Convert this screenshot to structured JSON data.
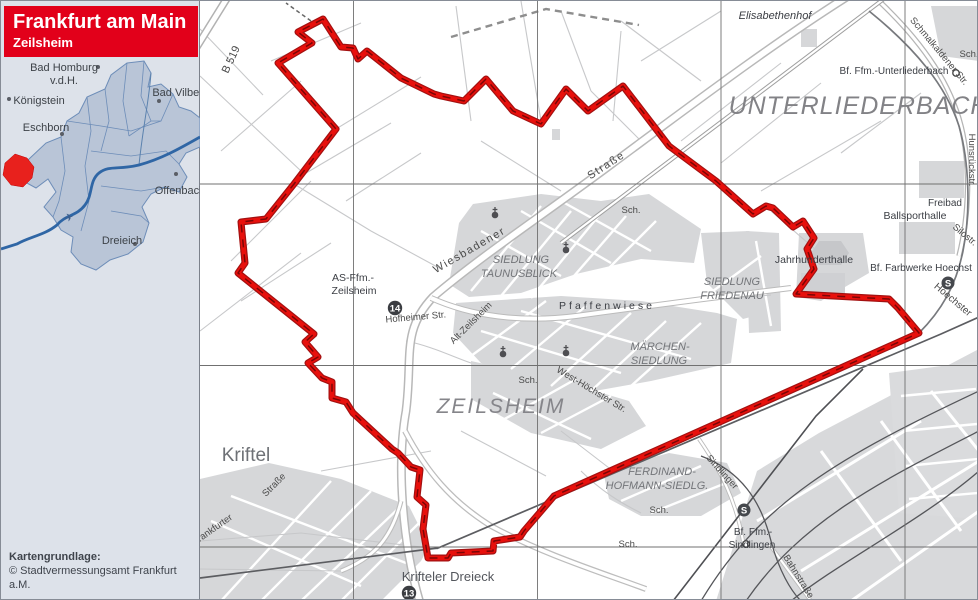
{
  "header": {
    "title": "Frankfurt am Main",
    "subtitle": "Zeilsheim"
  },
  "inset": {
    "bad_homburg_1": "Bad Homburg",
    "bad_homburg_2": "v.d.H.",
    "koenigstein": "Königstein",
    "bad_vilbel": "Bad Vilbel",
    "eschborn": "Eschborn",
    "offenbach": "Offenbach",
    "dreieich": "Dreieich",
    "airplane_icon": "✈"
  },
  "attribution": {
    "line1": "Kartengrundlage:",
    "line2": "© Stadtvermessungsamt Frankfurt a.M."
  },
  "map": {
    "b519": "B 519",
    "elisabethenhof": "Elisabethenhof",
    "schmalkaldener": "Schmalkaldener Str.",
    "bf_unterliederbach": "Bf. Ffm.-Unterliederbach",
    "unterliederbach": "UNTERLIEDERBACH",
    "sch": "Sch.",
    "hunsrueckstr": "Hunsrückstr.",
    "freibad": "Freibad",
    "ballsporthalle": "Ballsporthalle",
    "silostr": "Silostr.",
    "jahrhunderthalle": "Jahrhunderthalle",
    "bf_farbwerke": "Bf. Farbwerke Hoechst",
    "hoechster": "Hoechster",
    "wiesbadener": "Wiesbadener",
    "strasse": "Straße",
    "siedlung": "SIEDLUNG",
    "taunusblick": "TAUNUSBLICK",
    "friedenau": "FRIEDENAU",
    "pfaffenwiese": "Pfaffenwiese",
    "maerchen": "MÄRCHEN-",
    "as_ffm": "AS-Ffm.-",
    "zeilsheim_small": "Zeilsheim",
    "hofheimer": "Hofheimer Str.",
    "alt_zeilsheim": "Alt-Zeilsheim",
    "zeilsheim": "ZEILSHEIM",
    "west_hoechster": "West-Höchster Str.",
    "kriftel": "Kriftel",
    "frankfurter": "Frankfurter",
    "ferdinand": "FERDINAND-",
    "hofmann": "HOFMANN-SIEDLG.",
    "krifteler_dreieck": "Krifteler Dreieck",
    "sindlinger": "Sindlinger",
    "bf_ffm": "Bf. Ffm.-",
    "sindlingen": "Sindlingen",
    "bahnstrasse": "Bahnstraße",
    "badge_14": "14",
    "badge_13": "13",
    "sbahn": "S"
  },
  "colors": {
    "accent_red": "#e2001a",
    "boundary_red": "#e10000",
    "inset_fill": "#b9c5d7",
    "river_blue": "#2f66a5"
  }
}
